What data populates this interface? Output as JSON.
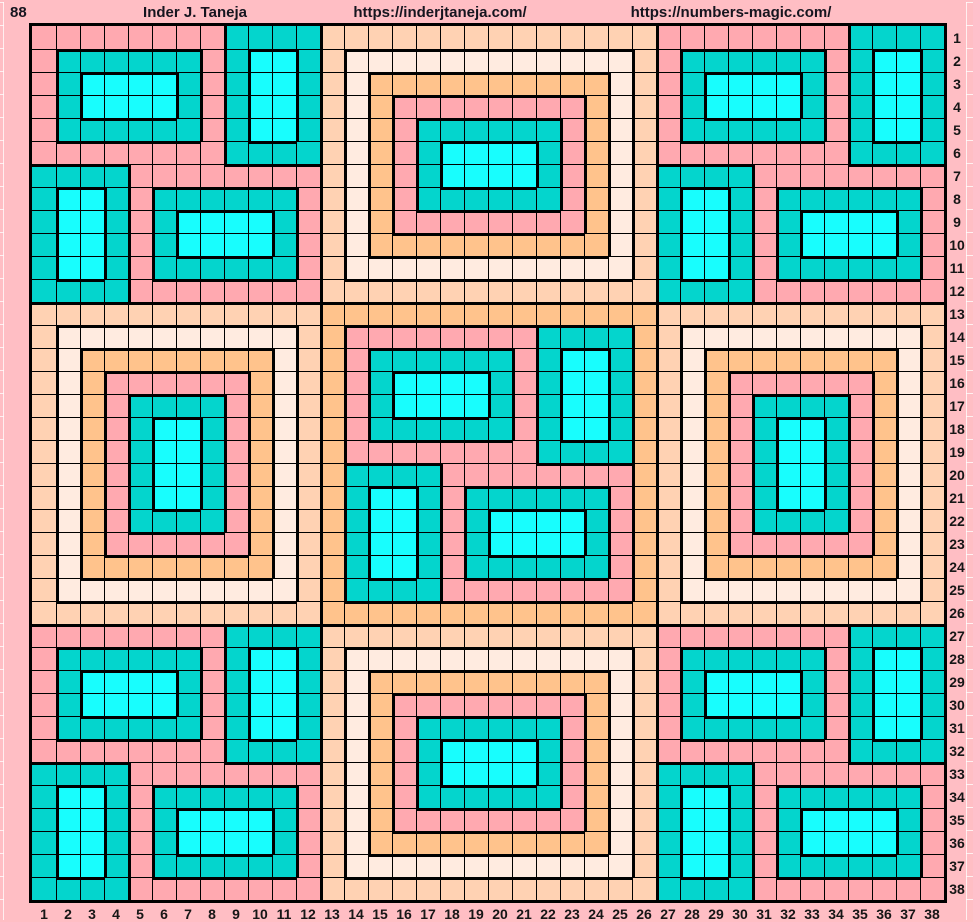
{
  "header": {
    "left_label": "88",
    "author": "Inder J. Taneja",
    "url1": "https://inderjtaneja.com/",
    "url2": "https://numbers-magic.com/"
  },
  "palette": {
    "P": "#FFA9B0",
    "T": "#04D5CD",
    "C": "#18FEFE",
    "O": "#FFC38C",
    "L": "#FFEBE0",
    "E": "#FFD2B3",
    "frame_pink": "#FFBEC4",
    "grid_line": "#000000",
    "label_text": "#161616"
  },
  "axis": {
    "cols": [
      "1",
      "2",
      "3",
      "4",
      "5",
      "6",
      "7",
      "8",
      "9",
      "10",
      "11",
      "12",
      "13",
      "14",
      "15",
      "16",
      "17",
      "18",
      "19",
      "20",
      "21",
      "22",
      "23",
      "24",
      "25",
      "26",
      "27",
      "28",
      "29",
      "30",
      "31",
      "32",
      "33",
      "34",
      "35",
      "36",
      "37",
      "38"
    ],
    "rows": [
      "1",
      "2",
      "3",
      "4",
      "5",
      "6",
      "7",
      "8",
      "9",
      "10",
      "11",
      "12",
      "13",
      "14",
      "15",
      "16",
      "17",
      "18",
      "19",
      "20",
      "21",
      "22",
      "23",
      "24",
      "25",
      "26",
      "27",
      "28",
      "29",
      "30",
      "31",
      "32",
      "33",
      "34",
      "35",
      "36",
      "37",
      "38"
    ]
  },
  "grid": {
    "size": 38,
    "legend": {
      "P": "pink",
      "T": "teal",
      "C": "bright-cyan",
      "O": "orange",
      "L": "pale-cream",
      "E": "peach"
    },
    "rows": [
      "PPPPPPPPTTTTEEEEEEEEEEEEEEPPPPPPPPTTTT",
      "PTTTTTTPTCCTELLLLLLLLLLLLEPTTTTTTPTCCT",
      "PTCCCCTPTCCTELOOOOOOOOOOLEPTCCCCTPTCCT",
      "PTCCCCTPTCCTELOPPPPPPPPOLEPTCCCCTPTCCT",
      "PTTTTTTPTCCTELOPTTTTTTPOLEPTTTTTTPTCCT",
      "PPPPPPPPTTTTELOPTCCCCTPOLEPPPPPPPPTTTT",
      "TTTTPPPPPPPPELOPTCCCCTPOLETTTTPPPPPPPP",
      "TCCTPTTTTTTPELOPTTTTTTPOLETCCTPTTTTTTP",
      "TCCTPTCCCCTPELOPPPPPPPPOLETCCTPTCCCCTP",
      "TCCTPTCCCCTPELOOOOOOOOOOLETCCTPTCCCCTP",
      "TCCTPTTTTTTPELLLLLLLLLLLLETCCTPTTTTTTP",
      "TTTTPPPPPPPPEEEEEEEEEEEEEETTTTPPPPPPPP",
      "EEEEEEEEEEEEOOOOOOOOOOOOOOEEEEEEEEEEEE",
      "ELLLLLLLLLLEOPPPPPPPPTTTTOELLLLLLLLLLE",
      "ELOOOOOOOOLEOPTTTTTTPTCCTOELOOOOOOOOLE",
      "ELOPPPPPPOLEOPTCCCCTPTCCTOELOPPPPPPOLE",
      "ELOPTTTTPOLEOPTCCCCTPTCCTOELOPTTTTPOLE",
      "ELOPTCCTPOLEOPTTTTTTPTCCTOELOPTCCTPOLE",
      "ELOPTCCTPOLEOPPPPPPPPTTTTOELOPTCCTPOLE",
      "ELOPTCCTPOLEOTTTTPPPPPPPPOELOPTCCTPOLE",
      "ELOPTCCTPOLEOTCCTPTTTTTTPOELOPTCCTPOLE",
      "ELOPTTTTPOLEOTCCTPTCCCCTPOELOPTTTTPOLE",
      "ELOPPPPPPOLEOTCCTPTCCCCTPOELOPPPPPPOLE",
      "ELOOOOOOOOLEOTCCTPTTTTTTPOELOOOOOOOOLE",
      "ELLLLLLLLLLEOTTTTPPPPPPPPOELLLLLLLLLLE",
      "EEEEEEEEEEEEOOOOOOOOOOOOOOEEEEEEEEEEEE",
      "PPPPPPPPTTTTEEEEEEEEEEEEEEPPPPPPPPTTTT",
      "PTTTTTTPTCCTELLLLLLLLLLLLEPTTTTTTPTCCT",
      "PTCCCCTPTCCTELOOOOOOOOOOLEPTCCCCTPTCCT",
      "PTCCCCTPTCCTELOPPPPPPPPOLEPTCCCCTPTCCT",
      "PTTTTTTPTCCTELOPTTTTTTPOLEPTTTTTTPTCCT",
      "PPPPPPPPTTTTELOPTCCCCTPOLEPPPPPPPPTTTT",
      "TTTTPPPPPPPPELOPTCCCCTPOLETTTTPPPPPPPP",
      "TCCTPTTTTTTPELOPTTTTTTPOLETCCTPTTTTTTP",
      "TCCTPTCCCCTPELOPPPPPPPPOLETCCTPTCCCCTP",
      "TCCTPTCCCCTPELOOOOOOOOOOLETCCTPTCCCCTP",
      "TCCTPTTTTTTPELLLLLLLLLLLLETCCTPTTTTTTP",
      "TTTTPPPPPPPPEEEEEEEEEEEEEETTTTPPPPPPPP"
    ]
  }
}
